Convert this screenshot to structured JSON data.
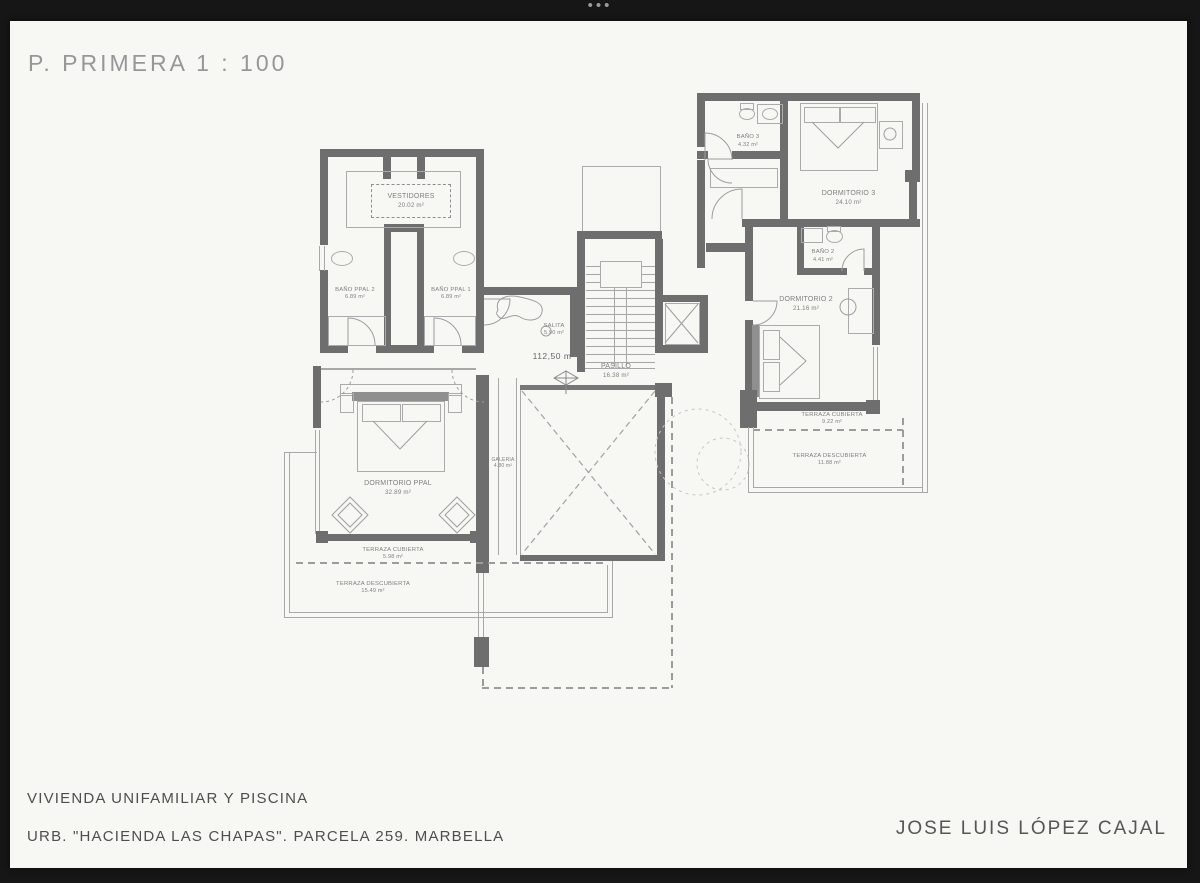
{
  "window": {
    "dots": "•••"
  },
  "title": "P. PRIMERA  1 : 100",
  "footer": {
    "line1": "VIVIENDA UNIFAMILIAR Y PISCINA",
    "line2": "URB. \"HACIENDA LAS CHAPAS\". PARCELA 259. MARBELLA",
    "architect": "JOSE LUIS LÓPEZ CAJAL"
  },
  "level_marker": "112,50 m",
  "rooms": {
    "vestidores": {
      "name": "VESTIDORES",
      "area": "20.02 m²"
    },
    "bano_ppal_2": {
      "name": "BAÑO PPAL 2",
      "area": "6.89 m²"
    },
    "bano_ppal_1": {
      "name": "BAÑO PPAL 1",
      "area": "6.89 m²"
    },
    "salita": {
      "name": "SALITA",
      "area": "5.90 m²"
    },
    "pasillo": {
      "name": "PASILLO",
      "area": "16.38 m²"
    },
    "dormitorio_ppal": {
      "name": "DORMITORIO PPAL",
      "area": "32.89 m²"
    },
    "galeria": {
      "name": "GALERIA",
      "area": "4.80 m²"
    },
    "terraza_cubierta_izq": {
      "name": "TERRAZA CUBIERTA",
      "area": "5.98 m²"
    },
    "terraza_descubierta_izq": {
      "name": "TERRAZA DESCUBIERTA",
      "area": "15.49 m²"
    },
    "bano_3": {
      "name": "BAÑO 3",
      "area": "4.32 m²"
    },
    "dormitorio_3": {
      "name": "DORMITORIO 3",
      "area": "24.10 m²"
    },
    "bano_2": {
      "name": "BAÑO 2",
      "area": "4.41 m²"
    },
    "dormitorio_2": {
      "name": "DORMITORIO 2",
      "area": "21.16 m²"
    },
    "terraza_cubierta_der": {
      "name": "TERRAZA CUBIERTA",
      "area": "9.22 m²"
    },
    "terraza_descubierta_der": {
      "name": "TERRAZA DESCUBIERTA",
      "area": "11.88 m²"
    }
  },
  "colors": {
    "frame": "#161616",
    "page": "#f7f7f4",
    "wall": "#6e6e6e",
    "thin_line": "#a8a8a8",
    "label_text": "#7f7f7f"
  }
}
